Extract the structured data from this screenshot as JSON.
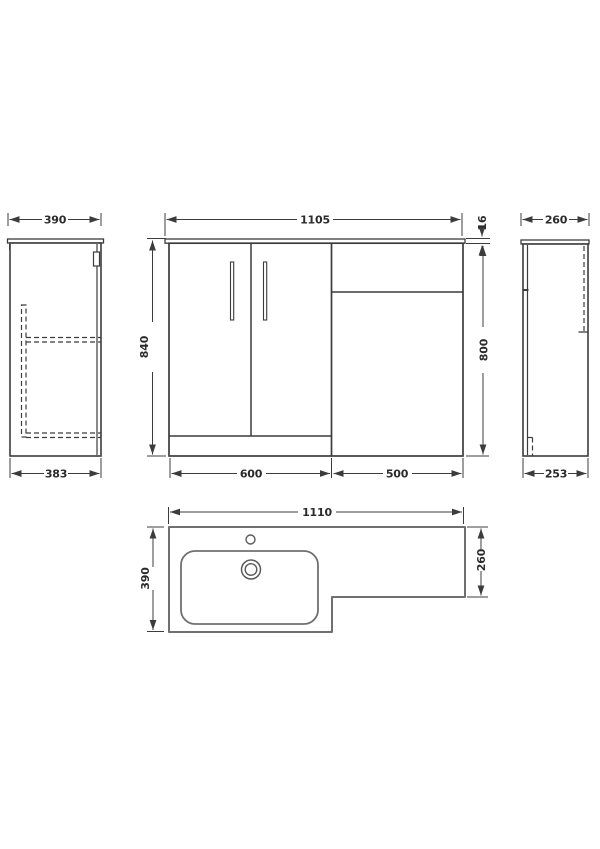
{
  "title": "L-shaped bathroom vanity and WC unit technical drawing",
  "colors": {
    "background": "#ffffff",
    "line": "#3c3c3c",
    "plan_line": "#707070",
    "text": "#2b2b2b"
  },
  "views": {
    "left_side": {
      "dim_top": "390",
      "dim_bottom": "383"
    },
    "front": {
      "dim_width": "1105",
      "dim_worktop": "16",
      "dim_height": "840",
      "dim_unit_height": "800",
      "dim_vanity_width": "600",
      "dim_wc_width": "500"
    },
    "right_side": {
      "dim_top": "260",
      "dim_bottom": "253"
    },
    "plan": {
      "dim_width": "1110",
      "dim_depth": "390",
      "dim_wc_depth": "260"
    }
  }
}
